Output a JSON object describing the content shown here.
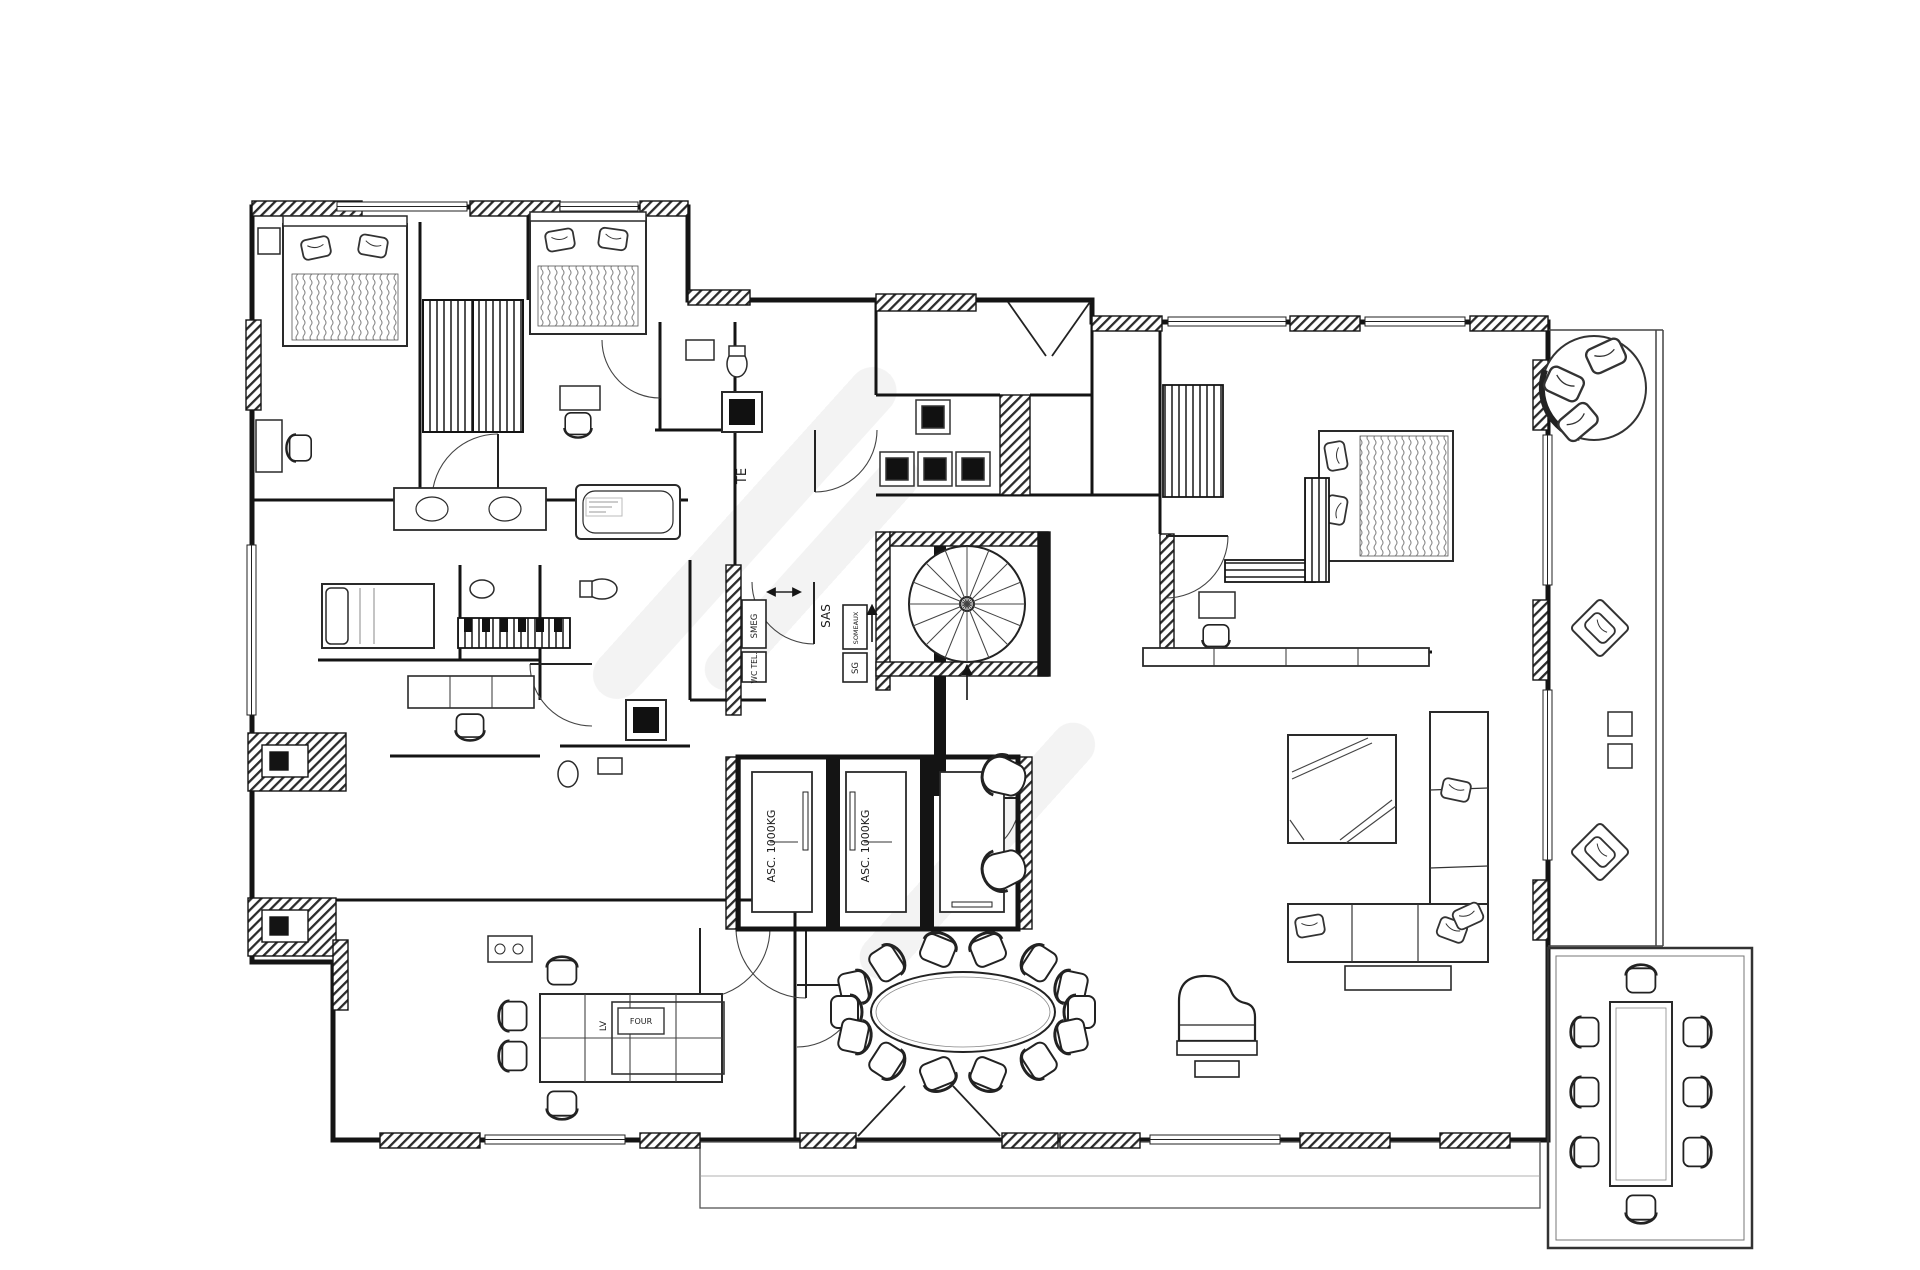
{
  "header": {
    "title": "FLOOR PLAN"
  },
  "plan": {
    "labels": {
      "te": "TE",
      "sas": "SAS",
      "smeg": "SMEG",
      "wc_tel": "WC TEL.",
      "someaux": "SOMEAUX",
      "sg": "SG",
      "asc_left": "ASC. 1000KG",
      "asc_right": "ASC. 1000KG",
      "lv": "LV",
      "four": "FOUR"
    },
    "colors": {
      "line": "#141414",
      "paper": "#ffffff",
      "edge": "#e9e9e9"
    }
  }
}
